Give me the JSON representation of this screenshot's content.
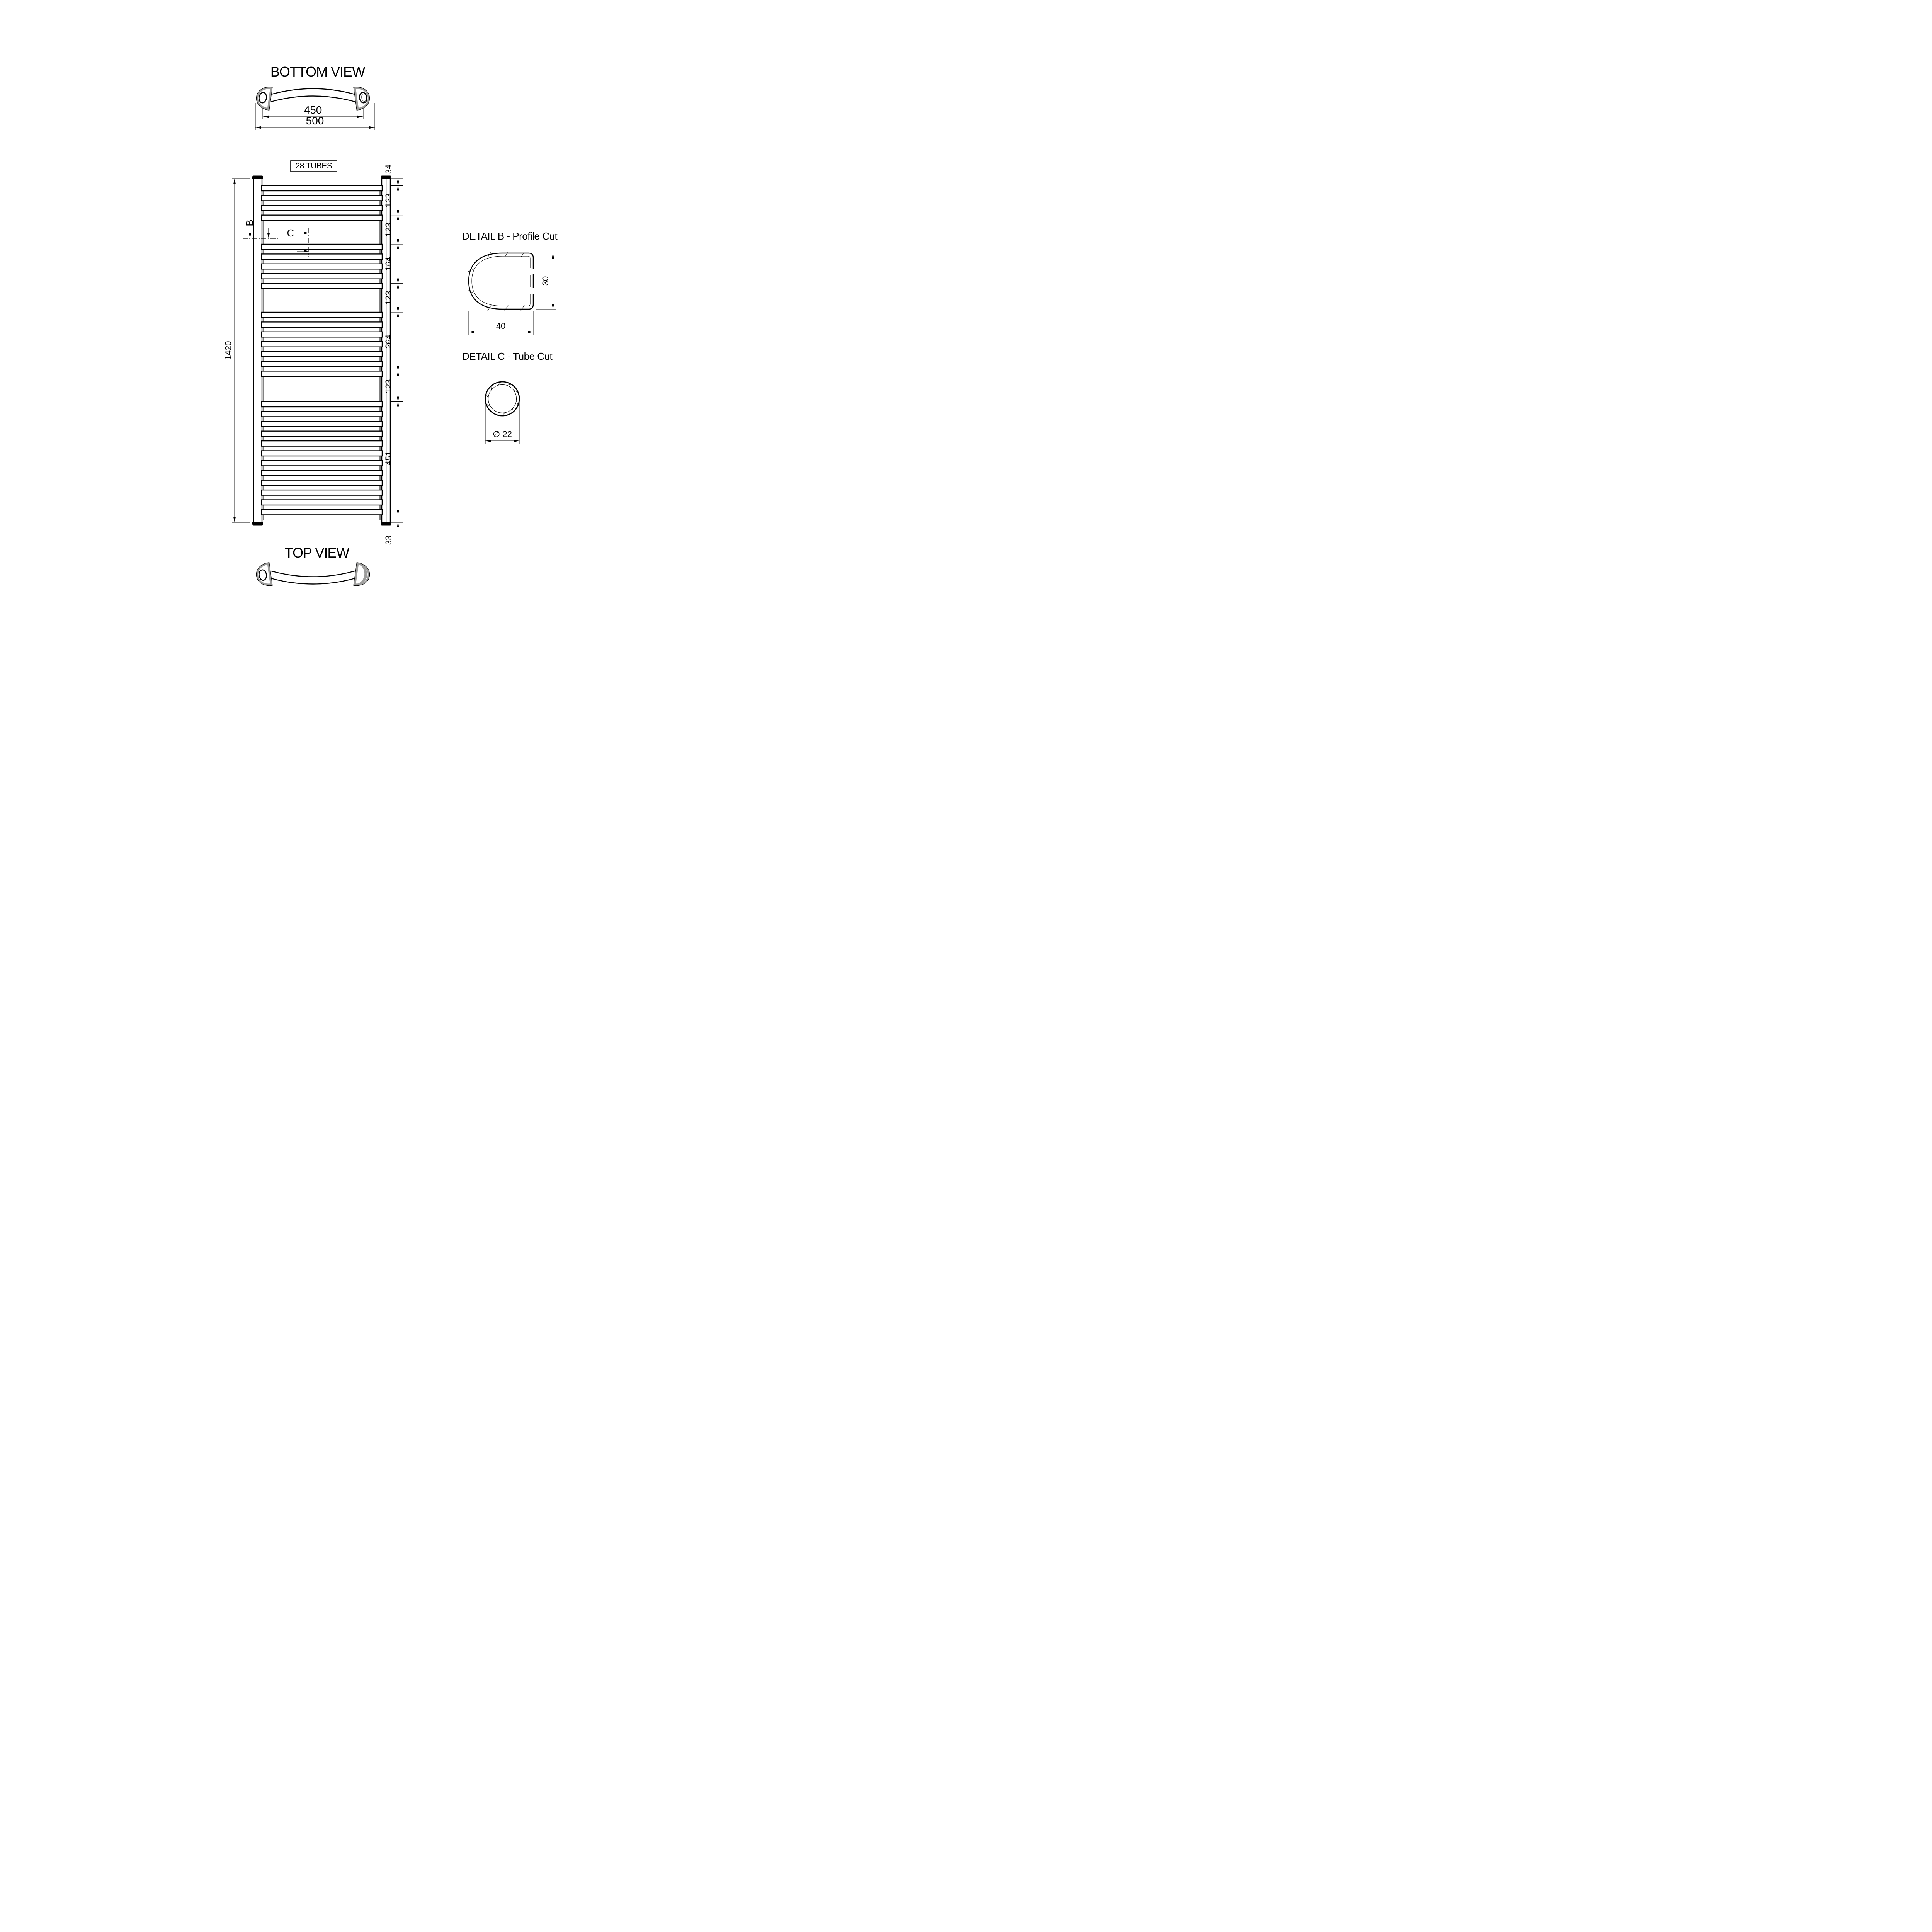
{
  "drawing": {
    "bottom_view": {
      "title": "BOTTOM VIEW",
      "dim_hole_centers": "450",
      "dim_overall_width": "500"
    },
    "front_view": {
      "tubes_label": "28 TUBES",
      "dim_overall_height": "1420",
      "marker_b": "B",
      "marker_c": "C",
      "tube_groups": [
        4,
        5,
        7,
        12
      ],
      "tube_count_total": 28,
      "right_dims": [
        "34",
        "123",
        "123",
        "164",
        "123",
        "264",
        "123",
        "451",
        "33"
      ]
    },
    "detail_b": {
      "title": "DETAIL B - Profile Cut",
      "dim_height": "30",
      "dim_width": "40"
    },
    "detail_c": {
      "title": "DETAIL C - Tube Cut",
      "dim_diameter": "∅ 22"
    },
    "top_view": {
      "title": "TOP VIEW"
    },
    "colors": {
      "line": "#000000",
      "accent_gray": "#9d9d9c",
      "background": "#ffffff"
    }
  }
}
